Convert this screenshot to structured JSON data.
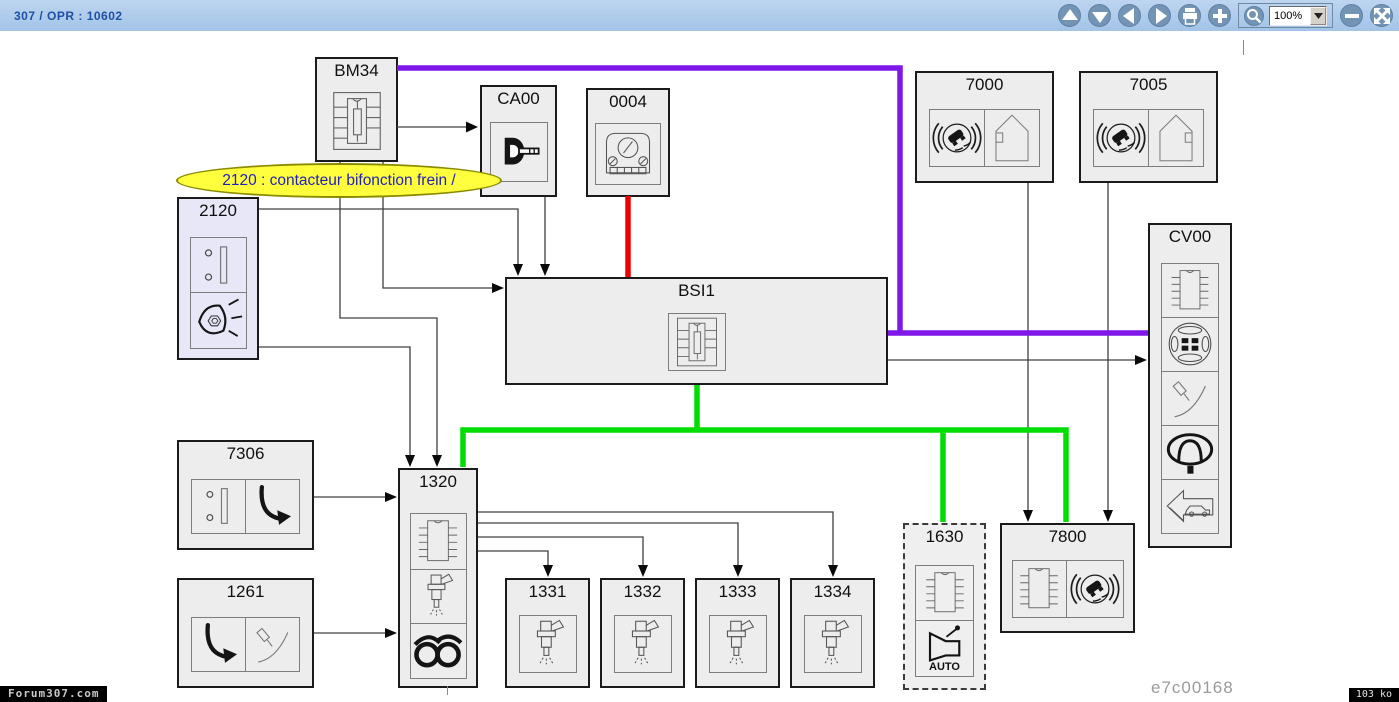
{
  "toolbar": {
    "breadcrumb": "307 / OPR : 10602",
    "zoom_value": "100%",
    "buttons": [
      "pan-up",
      "pan-down",
      "pan-left",
      "pan-right",
      "print",
      "zoom-in",
      "zoom-tool",
      "zoom-out",
      "fit-to-screen"
    ]
  },
  "tooltip": {
    "text": "2120 : contacteur bifonction frein /"
  },
  "diagram": {
    "components": [
      {
        "id": "BM34",
        "label": "BM34",
        "icons": [
          "fuse-box"
        ]
      },
      {
        "id": "CA00",
        "label": "CA00",
        "icons": [
          "ignition-key"
        ]
      },
      {
        "id": "0004",
        "label": "0004",
        "icons": [
          "instrument-cluster"
        ]
      },
      {
        "id": "7000",
        "label": "7000",
        "icons": [
          "abs-esp",
          "wheel-sensor"
        ]
      },
      {
        "id": "7005",
        "label": "7005",
        "icons": [
          "abs-esp",
          "wheel-sensor-mirrored"
        ]
      },
      {
        "id": "2120",
        "label": "2120",
        "icons": [
          "brake-switch",
          "brake-lamp"
        ],
        "highlighted": true
      },
      {
        "id": "BSI1",
        "label": "BSI1",
        "icons": [
          "fuse-box"
        ]
      },
      {
        "id": "CV00",
        "label": "CV00",
        "icons": [
          "ecu-chip",
          "steering-wheel",
          "column-stalk",
          "horn-pad",
          "car-reverse-arrow"
        ]
      },
      {
        "id": "7306",
        "label": "7306",
        "icons": [
          "switch",
          "pedal"
        ]
      },
      {
        "id": "1261",
        "label": "1261",
        "icons": [
          "pedal",
          "column-stalk"
        ]
      },
      {
        "id": "1320",
        "label": "1320",
        "icons": [
          "ecu-chip",
          "injector",
          "ignition-coil"
        ]
      },
      {
        "id": "1331",
        "label": "1331",
        "icons": [
          "injector"
        ]
      },
      {
        "id": "1332",
        "label": "1332",
        "icons": [
          "injector"
        ]
      },
      {
        "id": "1333",
        "label": "1333",
        "icons": [
          "injector"
        ]
      },
      {
        "id": "1334",
        "label": "1334",
        "icons": [
          "injector"
        ]
      },
      {
        "id": "1630",
        "label": "1630",
        "icons": [
          "ecu-chip",
          "auto-gearbox"
        ],
        "dashed": true,
        "auto_label": "AUTO"
      },
      {
        "id": "7800",
        "label": "7800",
        "icons": [
          "ecu-chip",
          "abs-esp"
        ]
      }
    ],
    "connections": [
      {
        "from": "BM34",
        "to": "CA00",
        "color": "black"
      },
      {
        "from": "BM34",
        "to": "BSI1",
        "color": "black"
      },
      {
        "from": "BM34",
        "to": "1320",
        "color": "black"
      },
      {
        "from": "BM34",
        "to": "CV00",
        "color": "purple"
      },
      {
        "from": "CA00",
        "to": "BSI1",
        "color": "black"
      },
      {
        "from": "2120",
        "to": "BSI1",
        "color": "black"
      },
      {
        "from": "2120",
        "to": "1320",
        "color": "black"
      },
      {
        "from": "0004",
        "to": "BSI1",
        "color": "red"
      },
      {
        "from": "BSI1",
        "to": "CV00",
        "color": "black"
      },
      {
        "from": "BSI1",
        "to": "1320",
        "color": "green"
      },
      {
        "from": "BSI1",
        "to": "1630",
        "color": "green"
      },
      {
        "from": "BSI1",
        "to": "7800",
        "color": "green"
      },
      {
        "from": "7306",
        "to": "1320",
        "color": "black"
      },
      {
        "from": "1261",
        "to": "1320",
        "color": "black"
      },
      {
        "from": "1320",
        "to": "1331",
        "color": "black"
      },
      {
        "from": "1320",
        "to": "1332",
        "color": "black"
      },
      {
        "from": "1320",
        "to": "1333",
        "color": "black"
      },
      {
        "from": "1320",
        "to": "1334",
        "color": "black"
      },
      {
        "from": "7000",
        "to": "7800",
        "color": "black"
      },
      {
        "from": "7005",
        "to": "7800",
        "color": "black"
      }
    ],
    "wire_colors": {
      "purple": "#7f17e8",
      "red": "#ee0000",
      "green": "#00dd00",
      "signal": "#404040"
    },
    "figure_code": "e7c00168"
  },
  "statusbar": {
    "watermark": "Forum307.com",
    "file_size": "103 ko"
  }
}
